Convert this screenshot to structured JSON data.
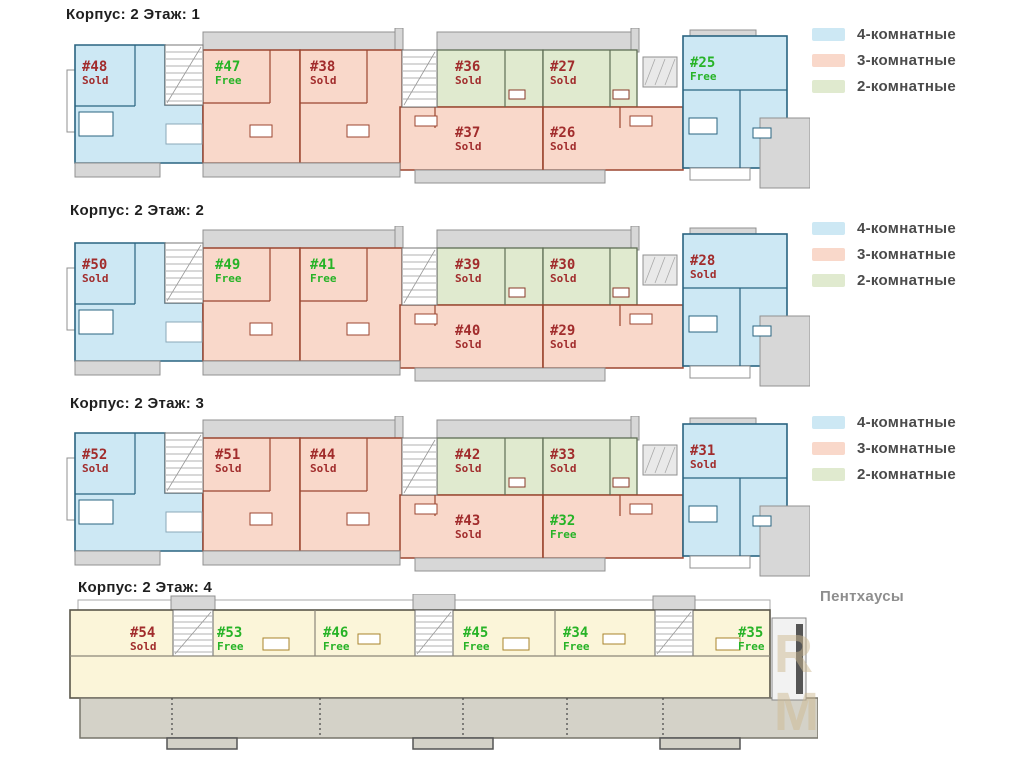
{
  "page": {
    "background": "#ffffff"
  },
  "legend": {
    "items": [
      {
        "label": "4-комнатные",
        "type": "blue"
      },
      {
        "label": "3-комнатные",
        "type": "pink"
      },
      {
        "label": "2-комнатные",
        "type": "green"
      }
    ]
  },
  "colors": {
    "blue_fill": "#cde8f4",
    "blue_wall": "#2a6480",
    "pink_fill": "#f9d8ca",
    "pink_wall": "#9c4630",
    "green_fill": "#e0eacf",
    "green_wall": "#5f6e55",
    "cream_fill": "#fbf5d9",
    "cream_wall": "#5a564a",
    "gray_fill": "#d7d7d7",
    "gray_stroke": "#909090",
    "terrace_fill": "#d4d2c8",
    "terrace_stroke": "#77756a",
    "fixture_red": "#8a3a2a",
    "fixture_gold": "#a8842c",
    "sold": "#a12c2c",
    "free": "#27b327",
    "title": "#1f1f1f",
    "legend_text": "#4b4b4b",
    "penthouse_label": "#8e8e8e"
  },
  "floors": [
    {
      "title": "Корпус: 2 Этаж: 1",
      "layout": "standard",
      "legend": true,
      "apartments": [
        {
          "slot": "left_blue",
          "number": "#48",
          "status": "Sold",
          "rooms": "4-комнатные"
        },
        {
          "slot": "pink_1",
          "number": "#47",
          "status": "Free",
          "rooms": "3-комнатные"
        },
        {
          "slot": "pink_2",
          "number": "#38",
          "status": "Sold",
          "rooms": "3-комнатные"
        },
        {
          "slot": "green_1",
          "number": "#36",
          "status": "Sold",
          "rooms": "2-комнатные"
        },
        {
          "slot": "green_2",
          "number": "#27",
          "status": "Sold",
          "rooms": "2-комнатные"
        },
        {
          "slot": "pink_low_1",
          "number": "#37",
          "status": "Sold",
          "rooms": "3-комнатные"
        },
        {
          "slot": "pink_low_2",
          "number": "#26",
          "status": "Sold",
          "rooms": "3-комнатные"
        },
        {
          "slot": "right_blue",
          "number": "#25",
          "status": "Free",
          "rooms": "4-комнатные"
        }
      ]
    },
    {
      "title": "Корпус: 2 Этаж: 2",
      "layout": "standard",
      "legend": true,
      "apartments": [
        {
          "slot": "left_blue",
          "number": "#50",
          "status": "Sold",
          "rooms": "4-комнатные"
        },
        {
          "slot": "pink_1",
          "number": "#49",
          "status": "Free",
          "rooms": "3-комнатные"
        },
        {
          "slot": "pink_2",
          "number": "#41",
          "status": "Free",
          "rooms": "3-комнатные"
        },
        {
          "slot": "green_1",
          "number": "#39",
          "status": "Sold",
          "rooms": "2-комнатные"
        },
        {
          "slot": "green_2",
          "number": "#30",
          "status": "Sold",
          "rooms": "2-комнатные"
        },
        {
          "slot": "pink_low_1",
          "number": "#40",
          "status": "Sold",
          "rooms": "3-комнатные"
        },
        {
          "slot": "pink_low_2",
          "number": "#29",
          "status": "Sold",
          "rooms": "3-комнатные"
        },
        {
          "slot": "right_blue",
          "number": "#28",
          "status": "Sold",
          "rooms": "4-комнатные"
        }
      ]
    },
    {
      "title": "Корпус: 2 Этаж: 3",
      "layout": "standard",
      "legend": true,
      "apartments": [
        {
          "slot": "left_blue",
          "number": "#52",
          "status": "Sold",
          "rooms": "4-комнатные"
        },
        {
          "slot": "pink_1",
          "number": "#51",
          "status": "Sold",
          "rooms": "3-комнатные"
        },
        {
          "slot": "pink_2",
          "number": "#44",
          "status": "Sold",
          "rooms": "3-комнатные"
        },
        {
          "slot": "green_1",
          "number": "#42",
          "status": "Sold",
          "rooms": "2-комнатные"
        },
        {
          "slot": "green_2",
          "number": "#33",
          "status": "Sold",
          "rooms": "2-комнатные"
        },
        {
          "slot": "pink_low_1",
          "number": "#43",
          "status": "Sold",
          "rooms": "3-комнатные"
        },
        {
          "slot": "pink_low_2",
          "number": "#32",
          "status": "Free",
          "rooms": "3-комнатные"
        },
        {
          "slot": "right_blue",
          "number": "#31",
          "status": "Sold",
          "rooms": "4-комнатные"
        }
      ]
    },
    {
      "title": "Корпус: 2 Этаж: 4",
      "layout": "penthouse",
      "legend": false,
      "section_label": "Пентхаусы",
      "apartments": [
        {
          "slot": "p1",
          "number": "#54",
          "status": "Sold",
          "rooms": "Пентхаус"
        },
        {
          "slot": "p2",
          "number": "#53",
          "status": "Free",
          "rooms": "Пентхаус"
        },
        {
          "slot": "p3",
          "number": "#46",
          "status": "Free",
          "rooms": "Пентхаус"
        },
        {
          "slot": "p4",
          "number": "#45",
          "status": "Free",
          "rooms": "Пентхаус"
        },
        {
          "slot": "p5",
          "number": "#34",
          "status": "Free",
          "rooms": "Пентхаус"
        },
        {
          "slot": "p6",
          "number": "#35",
          "status": "Free",
          "rooms": "Пентхаус"
        }
      ]
    }
  ]
}
